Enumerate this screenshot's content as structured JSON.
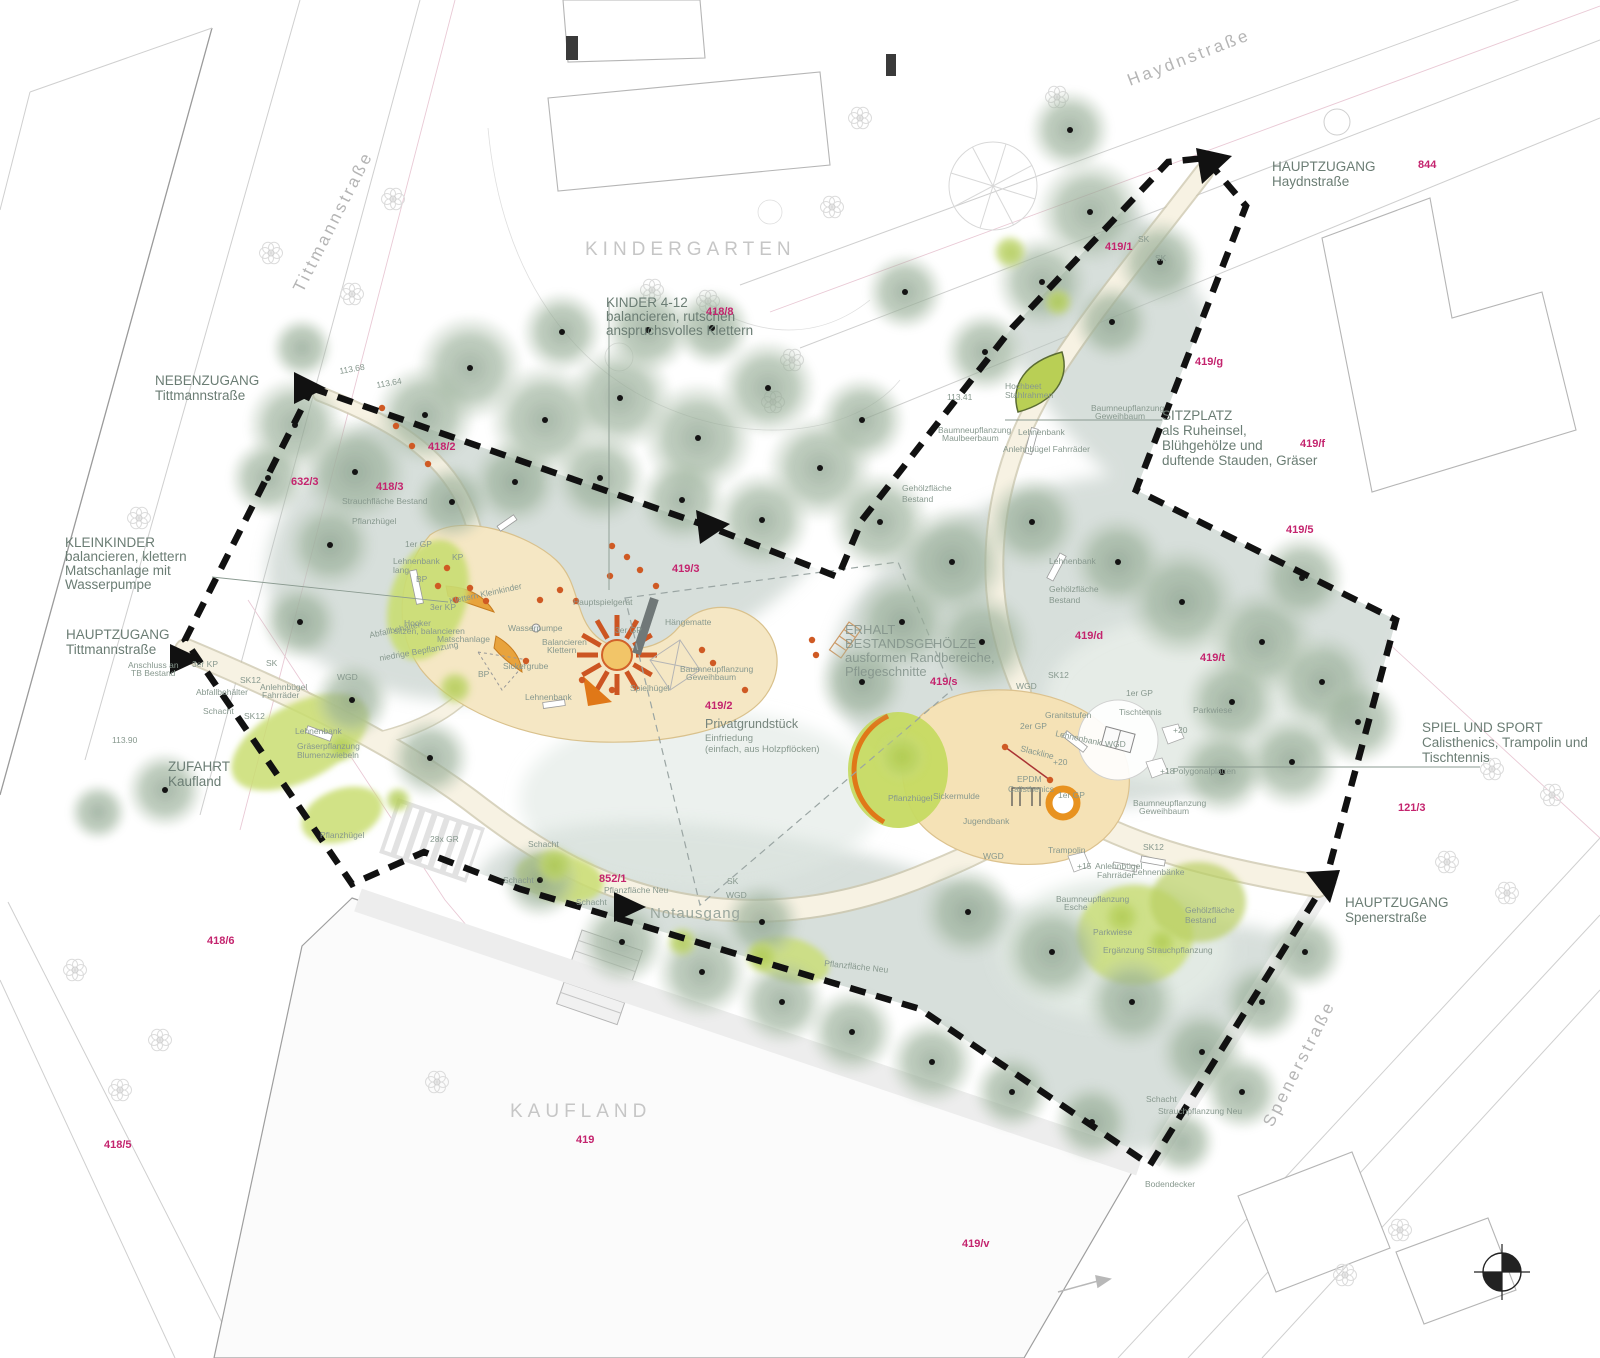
{
  "plan": {
    "colors": {
      "parcel_magenta": "#c4246e",
      "boundary_black": "#111111",
      "canopy_green": "#93a894",
      "understory_sage": "#b7c5be",
      "path_cream": "#f7f2e3",
      "play_sand": "#f5e7c4",
      "lawn_green": "#c8dd6e",
      "equipment_orange": "#e0761f",
      "label_green": "#6b7d74"
    },
    "streets": {
      "haydn": "Haydnstraße",
      "tittmann": "Tittmannstraße",
      "spener": "Spenerstraße"
    },
    "districts": {
      "kindergarten": "KINDERGARTEN",
      "kaufland": "KAUFLAND"
    },
    "entrances": {
      "haydn": {
        "l1": "HAUPTZUGANG",
        "l2": "Haydnstraße"
      },
      "neben": {
        "l1": "NEBENZUGANG",
        "l2": "Tittmannstraße"
      },
      "tittmann": {
        "l1": "HAUPTZUGANG",
        "l2": "Tittmannstraße"
      },
      "zufahrt": {
        "l1": "ZUFAHRT",
        "l2": "Kaufland"
      },
      "spener": {
        "l1": "HAUPTZUGANG",
        "l2": "Spenerstraße"
      },
      "notausgang": "Notausgang"
    },
    "callouts": {
      "kinder": {
        "l1": "KINDER 4-12",
        "l2": "balancieren, rutschen",
        "l3": "anspruchsvolles Klettern"
      },
      "kleinkinder": {
        "l1": "KLEINKINDER",
        "l2": "balancieren, klettern",
        "l3": "Matschanlage mit",
        "l4": "Wasserpumpe"
      },
      "sitzplatz": {
        "l1": "SITZPLATZ",
        "l2": "als Ruheinsel,",
        "l3": "Blühgehölze und",
        "l4": "duftende Stauden, Gräser"
      },
      "spielsport": {
        "l1": "SPIEL UND SPORT",
        "l2": "Calisthenics, Trampolin und",
        "l3": "Tischtennis"
      },
      "erhalt": {
        "l1": "ERHALT",
        "l2": "BESTANDSGEHÖLZE",
        "l3": "ausformen Randbereiche,",
        "l4": "Pflegeschnitte"
      },
      "privat": {
        "l1": "Privatgrundstück",
        "l2": "Einfriedung",
        "l3": "(einfach, aus Holzpflöcken)"
      }
    },
    "parcel_labels": [
      {
        "t": "844",
        "x": 1418,
        "y": 168
      },
      {
        "t": "419/g",
        "x": 1195,
        "y": 365
      },
      {
        "t": "419/f",
        "x": 1300,
        "y": 447
      },
      {
        "t": "419/5",
        "x": 1286,
        "y": 533
      },
      {
        "t": "418/8",
        "x": 706,
        "y": 315
      },
      {
        "t": "419/1",
        "x": 1105,
        "y": 250
      },
      {
        "t": "418/2",
        "x": 428,
        "y": 450
      },
      {
        "t": "418/3",
        "x": 376,
        "y": 490
      },
      {
        "t": "632/3",
        "x": 291,
        "y": 485
      },
      {
        "t": "419/3",
        "x": 672,
        "y": 572
      },
      {
        "t": "419/2",
        "x": 705,
        "y": 709
      },
      {
        "t": "419/s",
        "x": 930,
        "y": 685
      },
      {
        "t": "419/d",
        "x": 1075,
        "y": 639
      },
      {
        "t": "419/t",
        "x": 1200,
        "y": 661
      },
      {
        "t": "121/3",
        "x": 1398,
        "y": 811
      },
      {
        "t": "852/1",
        "x": 599,
        "y": 882
      },
      {
        "t": "418/6",
        "x": 207,
        "y": 944
      },
      {
        "t": "418/5",
        "x": 104,
        "y": 1148
      },
      {
        "t": "419",
        "x": 576,
        "y": 1143
      },
      {
        "t": "419/v",
        "x": 962,
        "y": 1247
      }
    ],
    "tiny_labels": [
      {
        "t": "Strauchfläche Bestand",
        "x": 342,
        "y": 504
      },
      {
        "t": "Pflanzhügel",
        "x": 352,
        "y": 524
      },
      {
        "t": "1er GP",
        "x": 405,
        "y": 547
      },
      {
        "t": "Lehnenbank",
        "x": 393,
        "y": 564
      },
      {
        "t": "lang",
        "x": 393,
        "y": 573
      },
      {
        "t": "BP",
        "x": 416,
        "y": 582
      },
      {
        "t": "KP",
        "x": 452,
        "y": 560
      },
      {
        "t": "3er KP",
        "x": 430,
        "y": 610
      },
      {
        "t": "Hocker",
        "x": 404,
        "y": 626
      },
      {
        "t": "sitzen, balancieren",
        "x": 394,
        "y": 634
      },
      {
        "t": "Klettern Kleinkinder",
        "x": 450,
        "y": 604,
        "r": -12
      },
      {
        "t": "Matschanlage",
        "x": 437,
        "y": 642
      },
      {
        "t": "Wasserpumpe",
        "x": 508,
        "y": 631
      },
      {
        "t": "Balancieren",
        "x": 542,
        "y": 645
      },
      {
        "t": "Klettern",
        "x": 547,
        "y": 653
      },
      {
        "t": "niedrige Bepflanzung",
        "x": 380,
        "y": 661,
        "r": -10
      },
      {
        "t": "Sickergrube",
        "x": 503,
        "y": 669
      },
      {
        "t": "BP",
        "x": 478,
        "y": 677
      },
      {
        "t": "Hauptspielgerät",
        "x": 573,
        "y": 605
      },
      {
        "t": "3er GP",
        "x": 615,
        "y": 633
      },
      {
        "t": "Hängematte",
        "x": 665,
        "y": 625
      },
      {
        "t": "Spielhügel",
        "x": 630,
        "y": 691,
        "s": 10.5
      },
      {
        "t": "Lehnenbank",
        "x": 525,
        "y": 700
      },
      {
        "t": "Baumneupflanzung",
        "x": 680,
        "y": 672,
        "s": 7.5
      },
      {
        "t": "Geweihbaum",
        "x": 686,
        "y": 680,
        "s": 7.5
      },
      {
        "t": "Abfallbehälter",
        "x": 370,
        "y": 638,
        "r": -12
      },
      {
        "t": "Abfallbehälter",
        "x": 196,
        "y": 695
      },
      {
        "t": "Schacht",
        "x": 203,
        "y": 714
      },
      {
        "t": "SK12",
        "x": 240,
        "y": 683
      },
      {
        "t": "SK12",
        "x": 244,
        "y": 719
      },
      {
        "t": "Anlehnbügel",
        "x": 260,
        "y": 690
      },
      {
        "t": "Fahrräder",
        "x": 262,
        "y": 698
      },
      {
        "t": "3er KP",
        "x": 192,
        "y": 667
      },
      {
        "t": "SK",
        "x": 266,
        "y": 666
      },
      {
        "t": "Anschluss an",
        "x": 128,
        "y": 668,
        "s": 7.5
      },
      {
        "t": "TB Bestand",
        "x": 131,
        "y": 676,
        "s": 7.5
      },
      {
        "t": "WGD",
        "x": 337,
        "y": 680
      },
      {
        "t": "Lehnenbank",
        "x": 295,
        "y": 734
      },
      {
        "t": "Gräserpflanzung",
        "x": 297,
        "y": 749
      },
      {
        "t": "Blumenzwiebeln",
        "x": 297,
        "y": 758
      },
      {
        "t": "Pflanzhügel",
        "x": 320,
        "y": 838
      },
      {
        "t": "28x GR",
        "x": 430,
        "y": 842
      },
      {
        "t": "Schacht",
        "x": 528,
        "y": 847
      },
      {
        "t": "Schacht",
        "x": 503,
        "y": 883
      },
      {
        "t": "Schacht",
        "x": 576,
        "y": 905
      },
      {
        "t": "Pflanzfläche Neu",
        "x": 604,
        "y": 893
      },
      {
        "t": "WGD",
        "x": 726,
        "y": 898
      },
      {
        "t": "SK",
        "x": 727,
        "y": 884
      },
      {
        "t": "Pflanzfläche Neu",
        "x": 824,
        "y": 966,
        "r": 6
      },
      {
        "t": "Parkwiese",
        "x": 1093,
        "y": 935,
        "s": 10.5
      },
      {
        "t": "Gehölzfläche",
        "x": 1185,
        "y": 913
      },
      {
        "t": "Bestand",
        "x": 1185,
        "y": 923
      },
      {
        "t": "Ergänzung Strauchpflanzung",
        "x": 1103,
        "y": 953,
        "s": 7.5
      },
      {
        "t": "Schacht",
        "x": 1146,
        "y": 1102
      },
      {
        "t": "Strauchpflanzung Neu",
        "x": 1158,
        "y": 1114
      },
      {
        "t": "Bodendecker",
        "x": 1145,
        "y": 1187
      },
      {
        "t": "Baumneupflanzung",
        "x": 1056,
        "y": 902,
        "s": 7.5
      },
      {
        "t": "Esche",
        "x": 1064,
        "y": 910,
        "s": 7.5
      },
      {
        "t": "Sickermulde",
        "x": 933,
        "y": 799
      },
      {
        "t": "Pflanzhügel",
        "x": 888,
        "y": 801
      },
      {
        "t": "Jugendbank",
        "x": 963,
        "y": 824
      },
      {
        "t": "EPDM",
        "x": 1017,
        "y": 782
      },
      {
        "t": "Calisthenics",
        "x": 1008,
        "y": 792
      },
      {
        "t": "Slackline",
        "x": 1020,
        "y": 751,
        "r": 14
      },
      {
        "t": "2er GP",
        "x": 1020,
        "y": 729
      },
      {
        "t": "Granitstufen",
        "x": 1045,
        "y": 718
      },
      {
        "t": "Lehnenbank",
        "x": 1055,
        "y": 736,
        "r": 12
      },
      {
        "t": "1er GP",
        "x": 1058,
        "y": 798
      },
      {
        "t": "Trampolin",
        "x": 1048,
        "y": 853
      },
      {
        "t": "Tischtennis",
        "x": 1119,
        "y": 715
      },
      {
        "t": "WGD",
        "x": 1105,
        "y": 747
      },
      {
        "t": "1er GP",
        "x": 1126,
        "y": 696
      },
      {
        "t": "Parkwiese",
        "x": 1193,
        "y": 713,
        "s": 10.5
      },
      {
        "t": "Polygonalplatten",
        "x": 1173,
        "y": 774
      },
      {
        "t": "Anlehnbügel",
        "x": 1095,
        "y": 869
      },
      {
        "t": "Fahrräder",
        "x": 1097,
        "y": 878
      },
      {
        "t": "Lehnenbänke",
        "x": 1133,
        "y": 875
      },
      {
        "t": "WGD",
        "x": 983,
        "y": 859
      },
      {
        "t": "SK12",
        "x": 1143,
        "y": 850
      },
      {
        "t": "SK12",
        "x": 1048,
        "y": 678
      },
      {
        "t": "WGD",
        "x": 1016,
        "y": 689
      },
      {
        "t": "Baumneupflanzung",
        "x": 1133,
        "y": 806,
        "s": 7.5
      },
      {
        "t": "Geweihbaum",
        "x": 1139,
        "y": 814,
        "s": 7.5
      },
      {
        "t": "Hochbeet",
        "x": 1005,
        "y": 389
      },
      {
        "t": "Stahlrahmen",
        "x": 1005,
        "y": 398
      },
      {
        "t": "Baumneupflanzung",
        "x": 938,
        "y": 433,
        "s": 7.5
      },
      {
        "t": "Maulbeerbaum",
        "x": 942,
        "y": 441,
        "s": 7.5
      },
      {
        "t": "Lehnenbank",
        "x": 1018,
        "y": 435
      },
      {
        "t": "Anlehnbügel Fahrräder",
        "x": 1003,
        "y": 452
      },
      {
        "t": "Baumneupflanzung",
        "x": 1091,
        "y": 411,
        "s": 7.5
      },
      {
        "t": "Geweihbaum",
        "x": 1095,
        "y": 419,
        "s": 7.5
      },
      {
        "t": "Gehölzfläche",
        "x": 902,
        "y": 491
      },
      {
        "t": "Bestand",
        "x": 902,
        "y": 502
      },
      {
        "t": "Gehölzfläche",
        "x": 1049,
        "y": 592
      },
      {
        "t": "Bestand",
        "x": 1049,
        "y": 603
      },
      {
        "t": "Lehnenbank",
        "x": 1049,
        "y": 564
      },
      {
        "t": "SK",
        "x": 1138,
        "y": 242
      },
      {
        "t": "SK",
        "x": 1155,
        "y": 261
      },
      {
        "t": "+20",
        "x": 1173,
        "y": 733,
        "s": 6.5
      },
      {
        "t": "+20",
        "x": 1053,
        "y": 765,
        "s": 6.5
      },
      {
        "t": "+18",
        "x": 1160,
        "y": 774,
        "s": 6.5
      },
      {
        "t": "+15",
        "x": 1077,
        "y": 869,
        "s": 6.5
      },
      {
        "t": "113.68",
        "x": 340,
        "y": 374,
        "s": 7,
        "r": -10
      },
      {
        "t": "113.64",
        "x": 377,
        "y": 388,
        "s": 7,
        "r": -10
      },
      {
        "t": "113.90",
        "x": 112,
        "y": 743,
        "s": 7
      },
      {
        "t": "113.41",
        "x": 947,
        "y": 400,
        "s": 7
      }
    ]
  }
}
